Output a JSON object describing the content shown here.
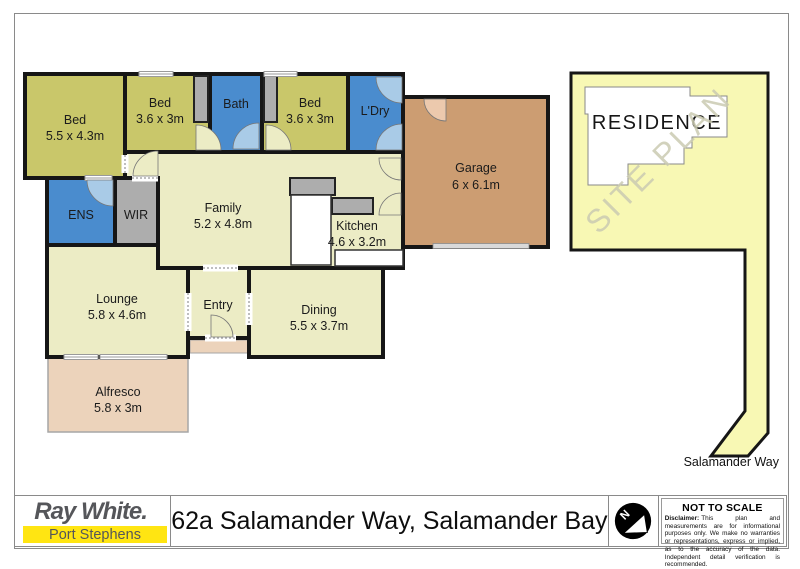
{
  "colors": {
    "bedroom_olive": "#c9c76a",
    "wet_area_blue": "#4a8cce",
    "living_cream": "#ececc5",
    "storage_gray": "#adadad",
    "garage_brown": "#cc9d72",
    "outdoor_tan": "#ecd3bb",
    "door_light_blue": "#a9cbe7",
    "garage_door_pink": "#ecc9ad",
    "site_plan_yellow": "#f8f8b4",
    "residence_white": "#ffffff",
    "wall_black": "#161616",
    "brand_yellow": "#ffe512",
    "brand_gray": "#55565a"
  },
  "floorplan": {
    "rooms": {
      "bed1": {
        "name": "Bed",
        "dims": "5.5 x 4.3m"
      },
      "bed2": {
        "name": "Bed",
        "dims": "3.6 x 3m"
      },
      "bath": {
        "name": "Bath",
        "dims": ""
      },
      "bed3": {
        "name": "Bed",
        "dims": "3.6 x 3m"
      },
      "ldry": {
        "name": "L'Dry",
        "dims": ""
      },
      "garage": {
        "name": "Garage",
        "dims": "6 x 6.1m"
      },
      "ens": {
        "name": "ENS",
        "dims": ""
      },
      "wir": {
        "name": "WIR",
        "dims": ""
      },
      "family": {
        "name": "Family",
        "dims": "5.2 x 4.8m"
      },
      "kitchen": {
        "name": "Kitchen",
        "dims": "4.6 x 3.2m"
      },
      "lounge": {
        "name": "Lounge",
        "dims": "5.8 x 4.6m"
      },
      "entry": {
        "name": "Entry",
        "dims": ""
      },
      "dining": {
        "name": "Dining",
        "dims": "5.5 x 3.7m"
      },
      "alfresco": {
        "name": "Alfresco",
        "dims": "5.8 x 3m"
      }
    }
  },
  "siteplan": {
    "residence_label": "RESIDENCE",
    "watermark": "SITE PLAN",
    "street_label": "Salamander Way"
  },
  "footer": {
    "brand": "Ray White.",
    "office": "Port Stephens",
    "address": "62a Salamander Way, Salamander Bay",
    "compass_letter": "N",
    "scale_note": "NOT TO SCALE",
    "disclaimer_label": "Disclaimer:",
    "disclaimer_text": "This plan and measurements are for informational purposes only. We make no warranties or representations, express or implied, as to the accuracy of the data. Independent detail verification is recommended."
  }
}
